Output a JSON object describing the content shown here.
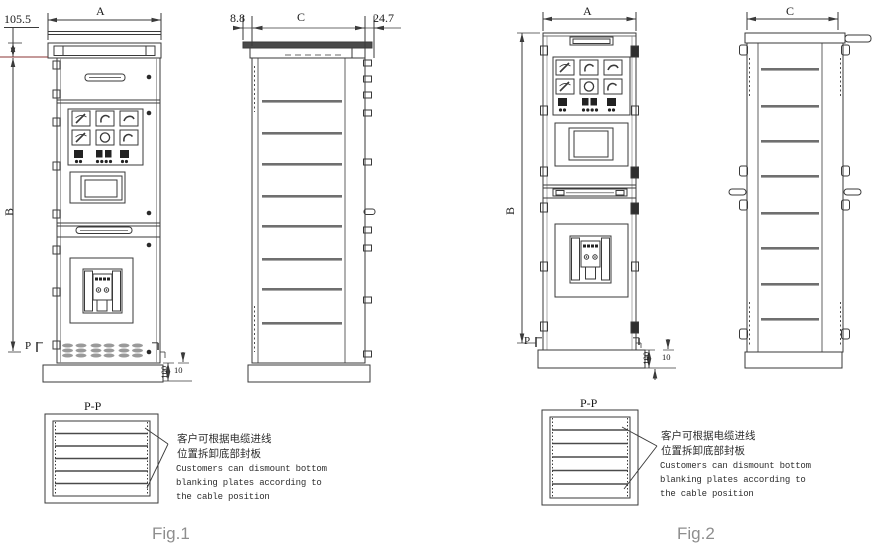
{
  "colors": {
    "line": "#3a3a3a",
    "accent_red": "#8b3434",
    "caption_gray": "#8e8e8e",
    "louver_gray": "#9a9a9a"
  },
  "fig1": {
    "caption": "Fig.1",
    "dims": {
      "width": "A",
      "height": "B",
      "depth": "C",
      "top": "105.5",
      "front_offset": "8.8",
      "rear_offset": "24.7",
      "base_height": "100",
      "base_inset": "10",
      "section_mark": "P",
      "section_title": "P-P"
    },
    "note": {
      "zh_line1": "客户可根据电缆进线",
      "zh_line2": "位置拆卸底部封板",
      "en_line1": "Customers can dismount bottom",
      "en_line2": "blanking plates according to",
      "en_line3": "the cable position"
    }
  },
  "fig2": {
    "caption": "Fig.2",
    "dims": {
      "width": "A",
      "height": "B",
      "depth": "C",
      "base_height": "100",
      "base_inset": "10",
      "section_mark": "P",
      "section_title": "P-P"
    },
    "note": {
      "zh_line1": "客户可根据电缆进线",
      "zh_line2": "位置拆卸底部封板",
      "en_line1": "Customers can dismount bottom",
      "en_line2": "blanking plates according to",
      "en_line3": "the cable position"
    }
  }
}
